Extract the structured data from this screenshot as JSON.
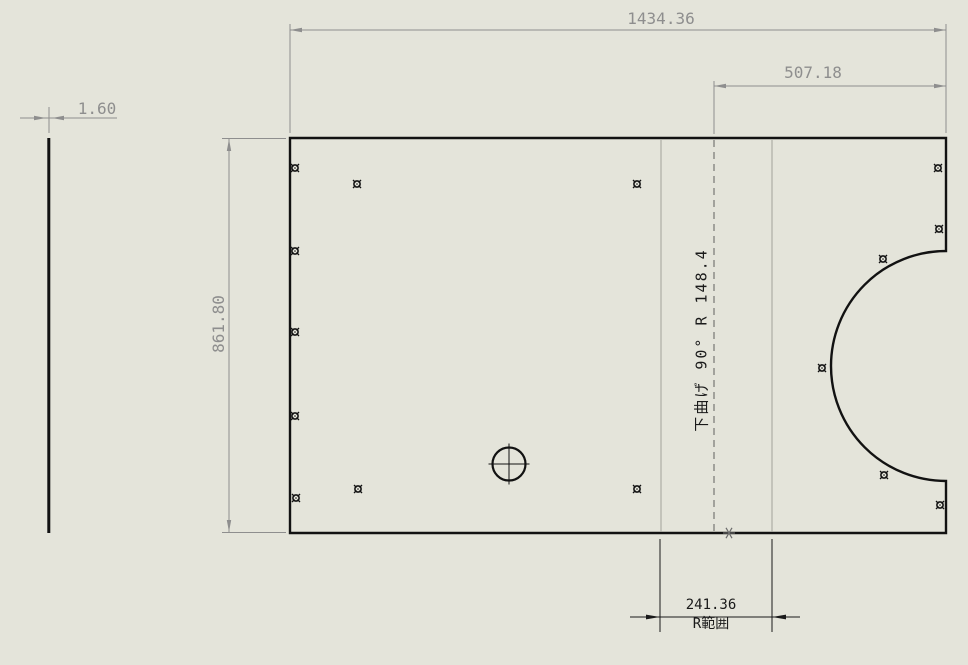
{
  "canvas": {
    "background": "#e4e4da",
    "edge_color": "#121212",
    "dim_gray": "#8e8e8e",
    "dim_black": "#1a1a1a",
    "bend_tangent_color": "#a2a29a",
    "bend_centerline_color": "#5f5f5f"
  },
  "dimensions": {
    "thickness": "1.60",
    "overall_width": "1434.36",
    "flange_offset": "507.18",
    "overall_height": "861.80",
    "bend_range_value": "241.36",
    "bend_range_label": "R範囲"
  },
  "notes": {
    "bend_note": "下曲げ 90° R 148.4"
  },
  "holes": [
    [
      295,
      168
    ],
    [
      357,
      184
    ],
    [
      637,
      184
    ],
    [
      938,
      168
    ],
    [
      295,
      251
    ],
    [
      939,
      229
    ],
    [
      883,
      259
    ],
    [
      295,
      332
    ],
    [
      822,
      368
    ],
    [
      295,
      416
    ],
    [
      296,
      498
    ],
    [
      358,
      489
    ],
    [
      637,
      489
    ],
    [
      884,
      475
    ],
    [
      940,
      505
    ]
  ],
  "center_mark_hole": {
    "x": 509,
    "y": 464,
    "r": 16.5
  }
}
